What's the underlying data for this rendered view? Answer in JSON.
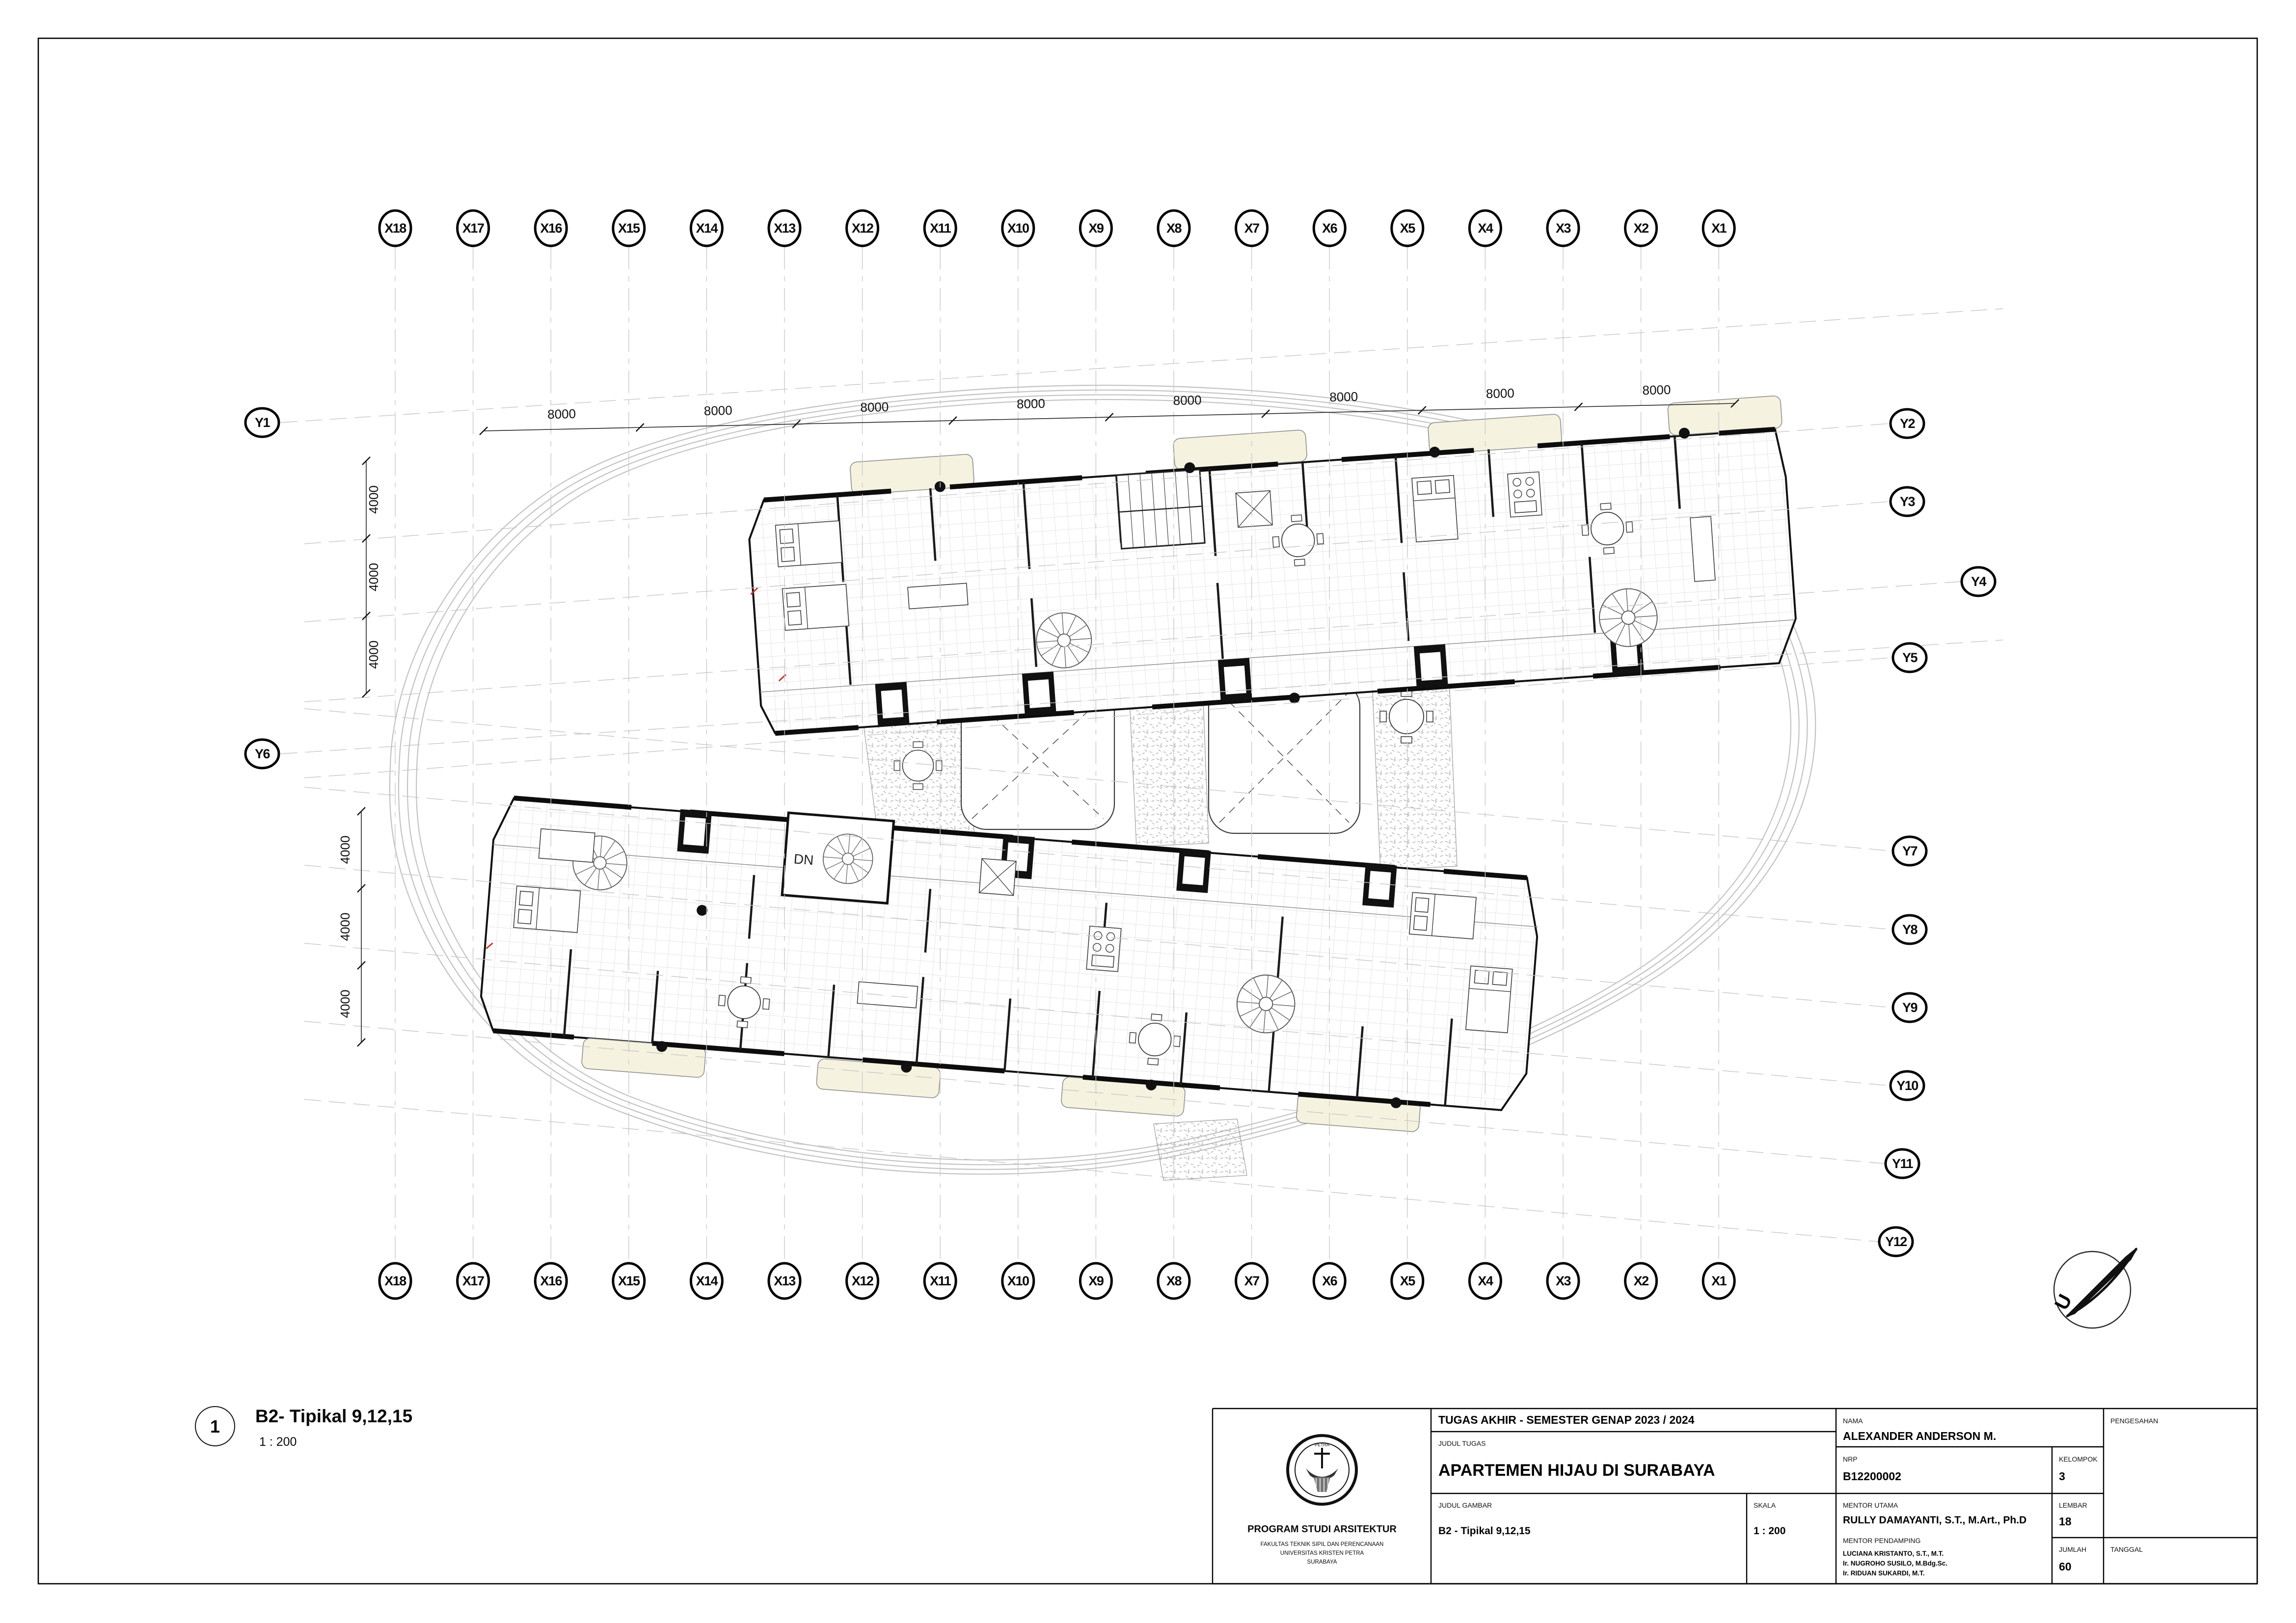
{
  "sheet": {
    "drawing_number": "1",
    "title": "B2- Tipikal 9,12,15",
    "scale_label": "1 : 200",
    "dn_label": "DN",
    "north_letter": "U"
  },
  "grid": {
    "x_labels": [
      "X18",
      "X17",
      "X16",
      "X15",
      "X14",
      "X13",
      "X12",
      "X11",
      "X10",
      "X9",
      "X8",
      "X7",
      "X6",
      "X5",
      "X4",
      "X3",
      "X2",
      "X1"
    ],
    "y_left": [
      "Y1",
      "Y6"
    ],
    "y_right": [
      "Y2",
      "Y3",
      "Y4",
      "Y5",
      "Y7",
      "Y8",
      "Y9",
      "Y10",
      "Y11",
      "Y12"
    ]
  },
  "dimensions": {
    "top": [
      "8000",
      "8000",
      "8000",
      "8000",
      "8000",
      "8000",
      "8000",
      "8000"
    ],
    "left_upper": [
      "4000",
      "4000",
      "4000"
    ],
    "left_lower": [
      "4000",
      "4000",
      "4000"
    ]
  },
  "title_block": {
    "header": "TUGAS AKHIR - SEMESTER GENAP 2023 / 2024",
    "judul_tugas_label": "JUDUL TUGAS",
    "judul_tugas": "APARTEMEN HIJAU DI SURABAYA",
    "judul_gambar_label": "JUDUL GAMBAR",
    "judul_gambar": "B2 - Tipikal 9,12,15",
    "skala_label": "SKALA",
    "skala": "1 : 200",
    "nama_label": "NAMA",
    "nama": "ALEXANDER ANDERSON M.",
    "nrp_label": "NRP",
    "nrp": "B12200002",
    "kelompok_label": "KELOMPOK",
    "kelompok": "3",
    "mentor_utama_label": "MENTOR UTAMA",
    "mentor_utama": "RULLY DAMAYANTI, S.T., M.Art., Ph.D",
    "mentor_pendamping_label": "MENTOR PENDAMPING",
    "mentor_pendamping": [
      "LUCIANA KRISTANTO, S.T., M.T.",
      "Ir. NUGROHO SUSILO, M.Bdg.Sc.",
      "Ir. RIDUAN SUKARDI, M.T."
    ],
    "lembar_label": "LEMBAR",
    "lembar": "18",
    "jumlah_label": "JUMLAH",
    "jumlah": "60",
    "pengesahan_label": "PENGESAHAN",
    "tanggal_label": "TANGGAL",
    "institution": {
      "program": "PROGRAM STUDI ARSITEKTUR",
      "faculty": "FAKULTAS TEKNIK SIPIL DAN PERENCANAAN",
      "university": "UNIVERSITAS KRISTEN PETRA",
      "city": "SURABAYA",
      "seal_bottom": "PETRA"
    }
  },
  "colors": {
    "balcony_cream": "#f5f2e0",
    "grid_light": "#c9c9c9",
    "wall_black": "#111111",
    "stipple_gray": "#b0b0b0"
  }
}
